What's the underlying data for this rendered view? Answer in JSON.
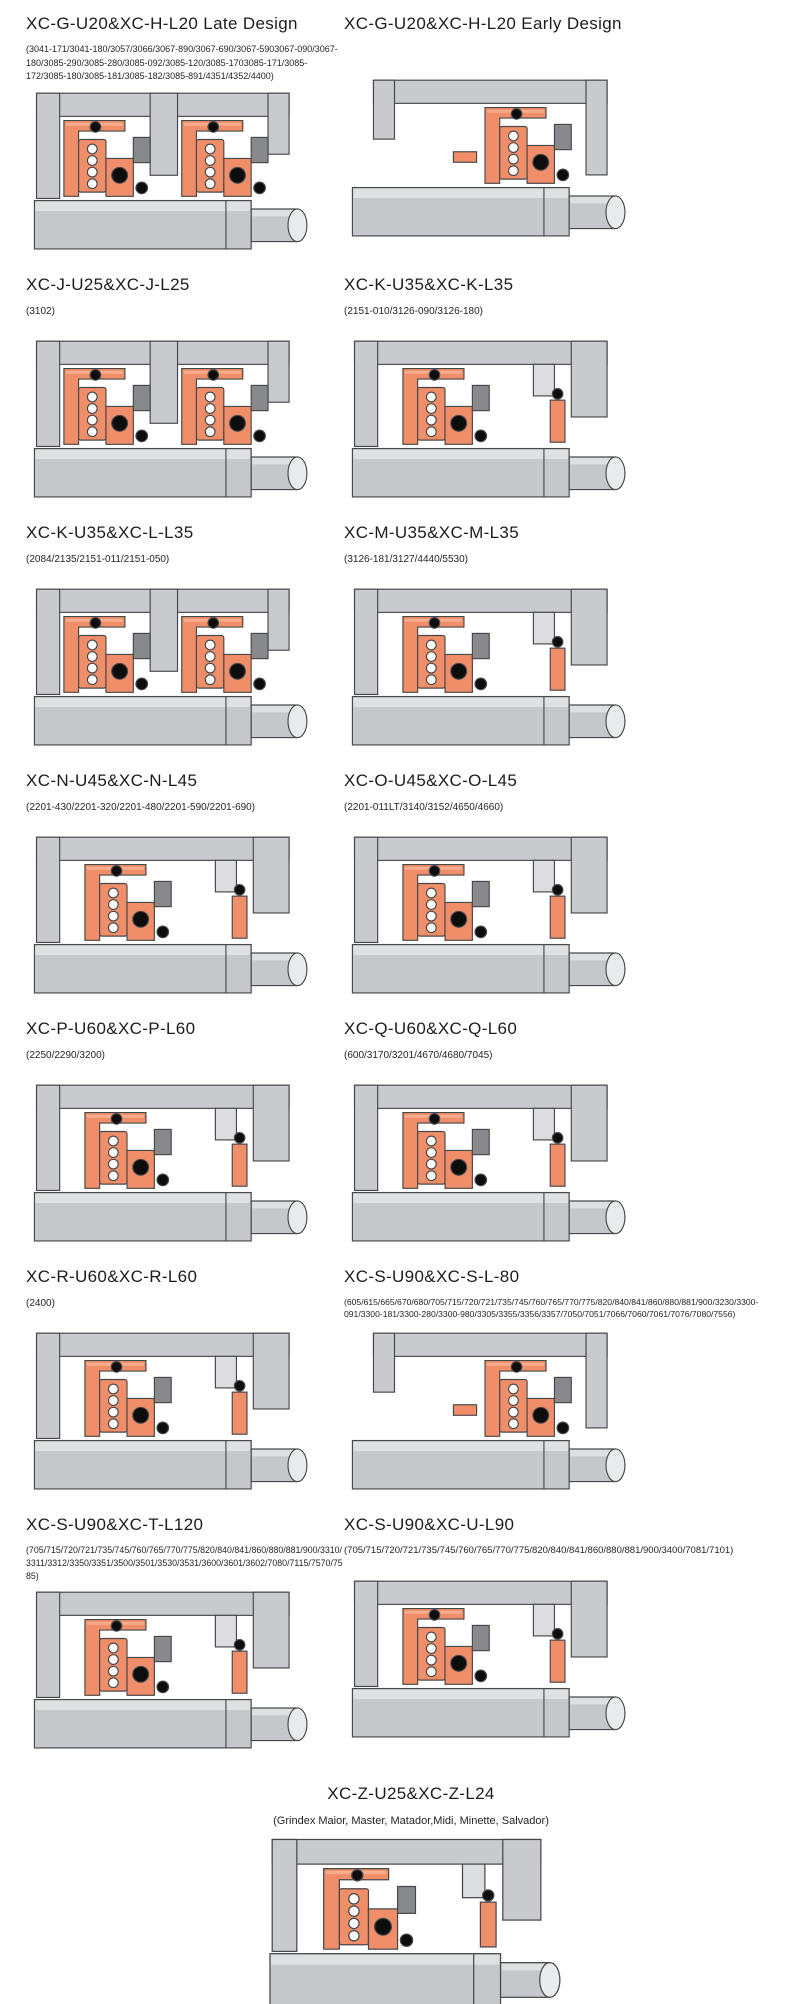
{
  "page": {
    "background": "#ffffff"
  },
  "colors": {
    "housing_gray": "#c9cacd",
    "housing_light": "#dcdde0",
    "shaft_gray": "#c6c7ca",
    "shaft_light": "#dfe0e2",
    "shaft_end": "#e9eaec",
    "seal_orange": "#ef8e68",
    "seal_orange_light": "#f5ab8c",
    "part_gray": "#87898d",
    "black": "#0d0d0d",
    "outline": "#47484c"
  },
  "sections": [
    {
      "title": "XC-G-U20&XC-H-L20 Late Design",
      "models": "(3041-171/3041-180/3057/3066/3067-890/3067-690/3067-5903067-090/3067-180/3085-290/3085-280/3085-092/3085-120/3085-1703085-171/3085-172/3085-180/3085-181/3085-182/3085-891/4351/4352/4400)",
      "diagram": "mechanical-seal-cross-section",
      "diagram_variant": "twin"
    },
    {
      "title": "XC-G-U20&XC-H-L20 Early Design",
      "models": "",
      "diagram": "mechanical-seal-cross-section",
      "diagram_variant": "right"
    },
    {
      "title": "XC-J-U25&XC-J-L25",
      "models": "(3102)",
      "diagram": "mechanical-seal-cross-section",
      "diagram_variant": "twin"
    },
    {
      "title": "XC-K-U35&XC-K-L35",
      "models": "(2151-010/3126-090/3126-180)",
      "diagram": "mechanical-seal-cross-section",
      "diagram_variant": "wide"
    },
    {
      "title": "XC-K-U35&XC-L-L35",
      "models": "(2084/2135/2151-011/2151-050)",
      "diagram": "mechanical-seal-cross-section",
      "diagram_variant": "twin"
    },
    {
      "title": "XC-M-U35&XC-M-L35",
      "models": "(3126-181/3127/4440/5530)",
      "diagram": "mechanical-seal-cross-section",
      "diagram_variant": "wide"
    },
    {
      "title": "XC-N-U45&XC-N-L45",
      "models": "(2201-430/2201-320/2201-480/2201-590/2201-690)",
      "diagram": "mechanical-seal-cross-section",
      "diagram_variant": "wide"
    },
    {
      "title": "XC-O-U45&XC-O-L45",
      "models": "(2201-011LT/3140/3152/4650/4660)",
      "diagram": "mechanical-seal-cross-section",
      "diagram_variant": "wide"
    },
    {
      "title": "XC-P-U60&XC-P-L60",
      "models": "(2250/2290/3200)",
      "diagram": "mechanical-seal-cross-section",
      "diagram_variant": "wide"
    },
    {
      "title": "XC-Q-U60&XC-Q-L60",
      "models": "(600/3170/3201/4670/4680/7045)",
      "diagram": "mechanical-seal-cross-section",
      "diagram_variant": "wide"
    },
    {
      "title": "XC-R-U60&XC-R-L60",
      "models": "(2400)",
      "diagram": "mechanical-seal-cross-section",
      "diagram_variant": "wide"
    },
    {
      "title": "XC-S-U90&XC-S-L-80",
      "models": "(605/615/665/670/680/705/715/720/721/735/745/760/765/770/775/820/840/841/860/880/881/900/3230/3300-091/3300-181/3300-280/3300-980/3305/3355/3356/3357/7050/7051/7066/7060/7061/7076/7080/7556)",
      "diagram": "mechanical-seal-cross-section",
      "diagram_variant": "right"
    },
    {
      "title": "XC-S-U90&XC-T-L120",
      "models": "(705/715/720/721/735/745/760/765/770/775/820/840/841/860/880/881/900/3310/3311/3312/3350/3351/3500/3501/3530/3531/3600/3601/3602/7080/7115/7570/7585)",
      "diagram": "mechanical-seal-cross-section",
      "diagram_variant": "wide"
    },
    {
      "title": "XC-S-U90&XC-U-L90",
      "models": "(705/715/720/721/735/745/760/765/770/775/820/840/841/860/880/881/900/3400/7081/7101)",
      "diagram": "mechanical-seal-cross-section",
      "diagram_variant": "wide"
    },
    {
      "title": "XC-Z-U25&XC-Z-L24",
      "models": "(Grindex  Maior, Master, Matador,Midi, Minette, Salvador)",
      "diagram": "mechanical-seal-cross-section",
      "diagram_variant": "wide"
    }
  ]
}
